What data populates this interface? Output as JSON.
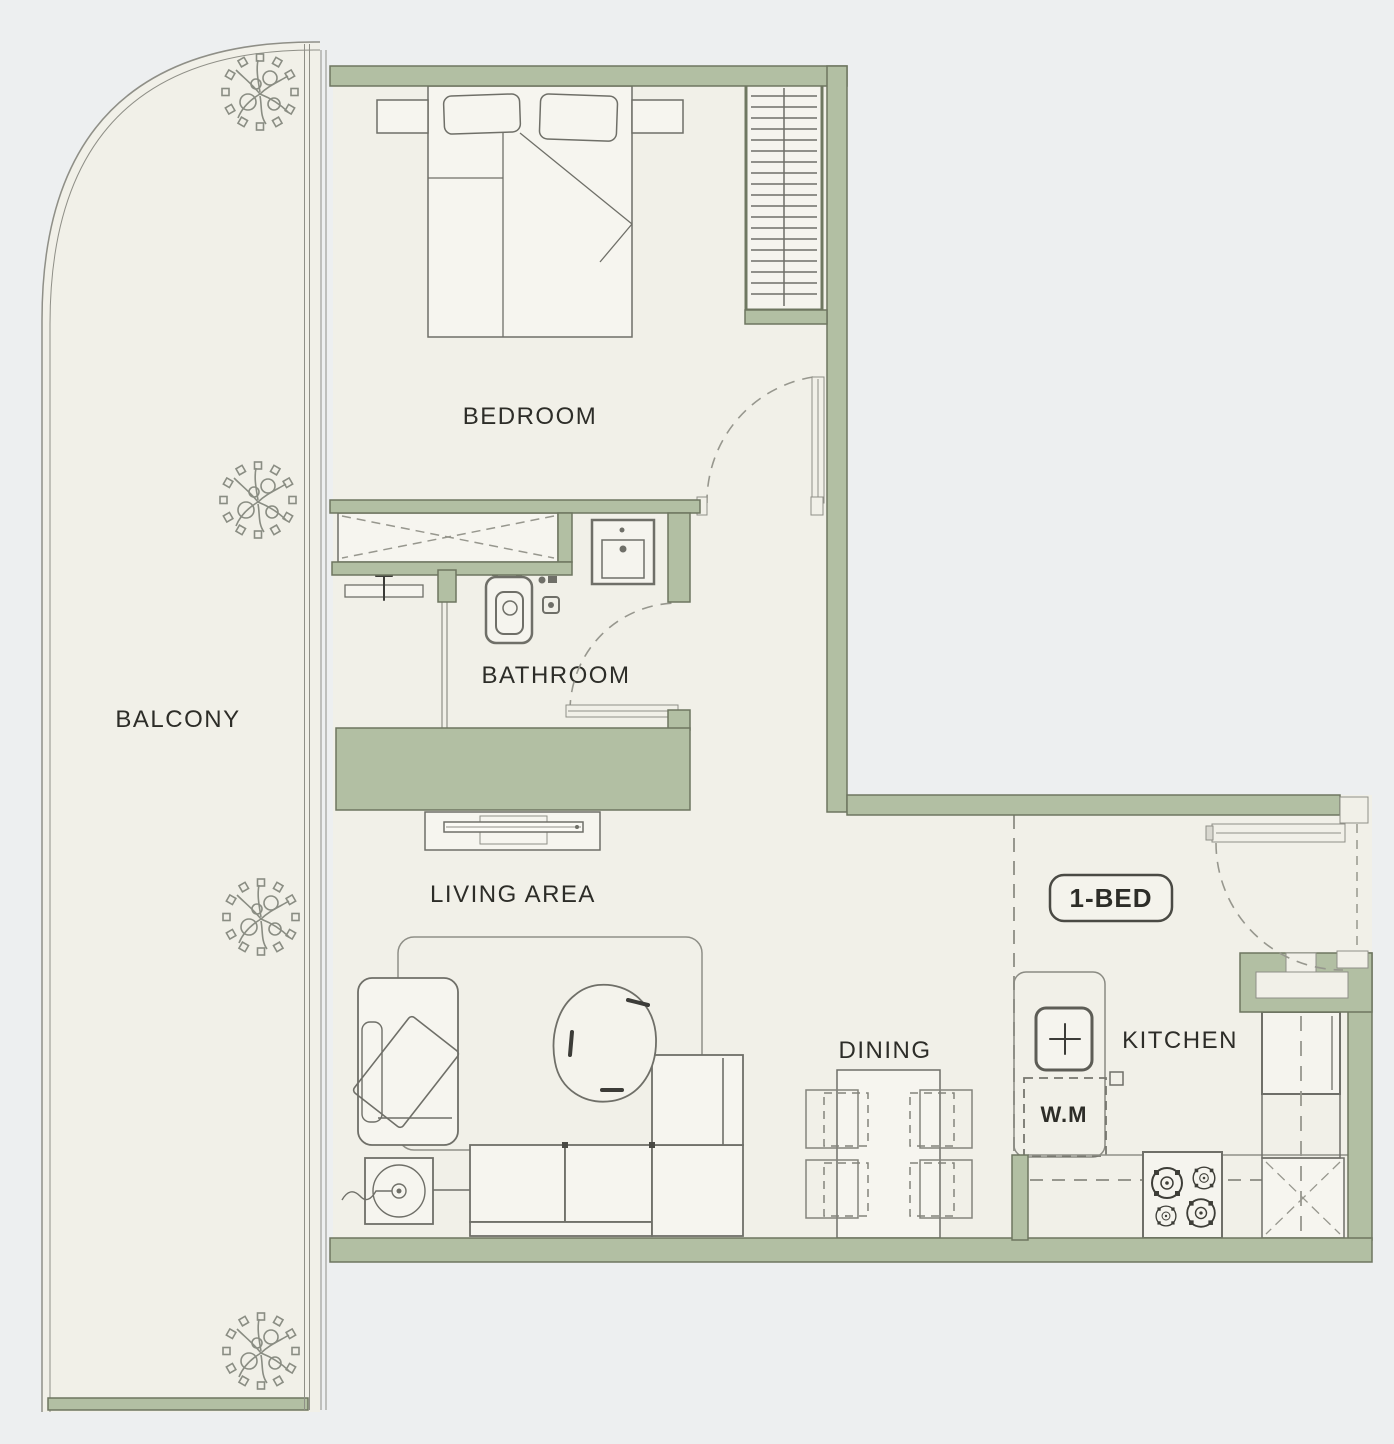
{
  "labels": {
    "balcony": "BALCONY",
    "bedroom": "BEDROOM",
    "bathroom": "BATHROOM",
    "living": "LIVING AREA",
    "dining": "DINING",
    "kitchen": "KITCHEN",
    "washing_machine": "W.M",
    "unit_type": "1-BED"
  },
  "colors": {
    "background": "#edeff0",
    "floor": "#f1f0e8",
    "fixture": "#f6f5ef",
    "wall": "#b2bfa3",
    "wall_edge": "#6e7660",
    "line": "#6f6f68",
    "line_soft": "#8f8f87",
    "dash": "#97978e",
    "text": "#2d2d28",
    "accent_dark": "#3c3c38"
  }
}
